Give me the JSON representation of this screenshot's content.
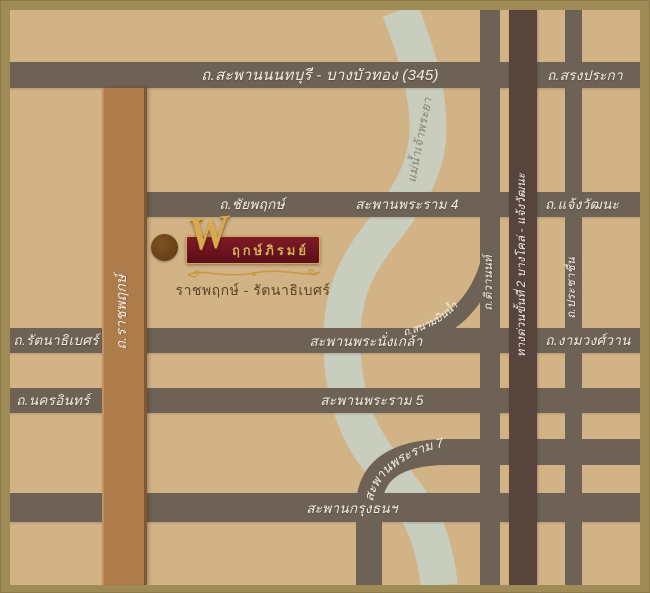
{
  "map": {
    "labels": {
      "road_345": "ถ.สะพานนนทบุรี - บางบัวทอง (345)",
      "song_praka": "ถ.สรงประกา",
      "chaiyaphruek": "ถ.ชัยพฤกษ์",
      "rama4": "สะพานพระราม 4",
      "chaengwattana": "ถ.แจ้งวัฒนะ",
      "rattanathibet": "ถ.รัตนาธิเบศร์",
      "nangklao": "สะพานพระนั่งเกล้า",
      "ngamwongwan": "ถ.งามวงศ์วาน",
      "nakhon_in": "ถ.นครอินทร์",
      "rama5": "สะพานพระราม 5",
      "rama7": "สะพานพระราม 7",
      "krungthon": "สะพานกรุงธนฯ",
      "ratchaphruek": "ถ.ราชพฤกษ์",
      "tiwanon": "ถ.ติวานนท์",
      "expressway": "ทางด่วนขั้นที่ 2 บางโคล่ - แจ้งวัฒนะ",
      "prachachuen": "ถ.ประชาชื่น",
      "sanambin_nam": "ถ.สนามบินน้ำ",
      "river": "แม่น้ำเจ้าพระยา"
    },
    "colors": {
      "frame": "#9f8b55",
      "background": "#d2b385",
      "road": "#6e6156",
      "expressway": "#57453d",
      "ratchaphruek_road": "#ae7c4b",
      "river": "#c8cdbd",
      "road_label": "#f5f0e6",
      "river_label": "#8b8270"
    }
  },
  "logo": {
    "monogram": "W",
    "name": "พฤกษ์ภิรมย์",
    "name_rest": "ฤกษ์ภิรมย์",
    "subtitle": "ราชพฤกษ์ - รัตนาธิเบศร์",
    "plate_color": "#6d1420",
    "gold_color": "#d9a94f",
    "subtitle_color": "#5a4529",
    "marker_color": "#6f4619"
  }
}
